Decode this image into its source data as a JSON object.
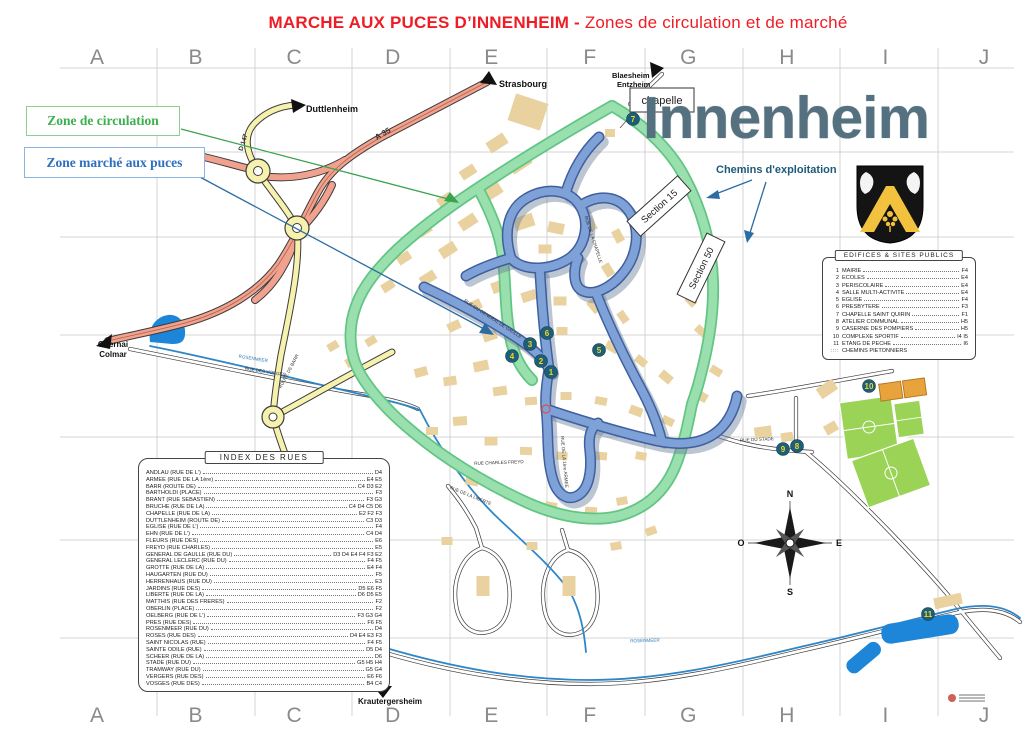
{
  "page_title": {
    "bold": "MARCHE AUX PUCES D’INNENHEIM - ",
    "regular": "Zones de circulation et de marché"
  },
  "town_name": "Innenheim",
  "legend": {
    "zone_circulation": "Zone de circulation",
    "zone_marche": "Zone marché aux puces",
    "chemins_exploitation": "Chemins d'exploitation"
  },
  "grid": {
    "letters": [
      "A",
      "B",
      "C",
      "D",
      "E",
      "F",
      "G",
      "H",
      "I",
      "J"
    ]
  },
  "destinations": [
    {
      "label": "Duttlenheim",
      "x": 306,
      "y": 112,
      "anchor": "start",
      "size": 9
    },
    {
      "label": "Strasbourg",
      "x": 499,
      "y": 87,
      "anchor": "start",
      "size": 9
    },
    {
      "label": "Blaesheim",
      "x": 612,
      "y": 78,
      "anchor": "start",
      "size": 7.5
    },
    {
      "label": "Entzheim",
      "x": 617,
      "y": 87,
      "anchor": "start",
      "size": 7.5
    },
    {
      "label": "Obernai",
      "x": 113,
      "y": 347,
      "anchor": "middle",
      "size": 8
    },
    {
      "label": "Colmar",
      "x": 113,
      "y": 357,
      "anchor": "middle",
      "size": 8
    },
    {
      "label": "Krautergersheim",
      "x": 390,
      "y": 704,
      "anchor": "middle",
      "size": 8
    }
  ],
  "road_refs": [
    {
      "label": "A 35",
      "x": 384,
      "y": 136,
      "rot": -30,
      "size": 8
    },
    {
      "label": "D 147",
      "x": 245,
      "y": 143,
      "rot": -72,
      "size": 6.5
    }
  ],
  "street_labels": [
    {
      "text": "RUE DES VOSGES",
      "x": 265,
      "y": 373,
      "rot": 9,
      "color": "#333"
    },
    {
      "text": "ROSENMEER",
      "x": 253,
      "y": 360,
      "rot": 9,
      "color": "#2a7fc0"
    },
    {
      "text": "ROSENMEER",
      "x": 645,
      "y": 642,
      "rot": -2,
      "color": "#2a7fc0"
    },
    {
      "text": "RUE CHARLES FREYD",
      "x": 499,
      "y": 464,
      "rot": -2,
      "color": "#333"
    },
    {
      "text": "RUE DU STADE",
      "x": 757,
      "y": 441,
      "rot": -3,
      "color": "#333"
    },
    {
      "text": "RUE DE LA LIBERTE",
      "x": 470,
      "y": 497,
      "rot": 22,
      "color": "#333"
    },
    {
      "text": "RUE DU GENERAL DE GAULLE",
      "x": 492,
      "y": 320,
      "rot": 33,
      "color": "#333"
    },
    {
      "text": "RUE DE LA CHAPELLE",
      "x": 592,
      "y": 240,
      "rot": 72,
      "color": "#333"
    },
    {
      "text": "ROUTE DE BARR",
      "x": 290,
      "y": 372,
      "rot": -62,
      "color": "#333"
    },
    {
      "text": "RUE DE LA 1ère ARMEE",
      "x": 563,
      "y": 462,
      "rot": 85,
      "color": "#333"
    }
  ],
  "boxed_labels": {
    "chapelle": "chapelle",
    "section15": "Section 15",
    "section50": "Section 50"
  },
  "markers": [
    {
      "n": "1",
      "x": 551,
      "y": 372
    },
    {
      "n": "2",
      "x": 541,
      "y": 361
    },
    {
      "n": "3",
      "x": 530,
      "y": 344
    },
    {
      "n": "4",
      "x": 512,
      "y": 356
    },
    {
      "n": "5",
      "x": 599,
      "y": 350
    },
    {
      "n": "6",
      "x": 547,
      "y": 333
    },
    {
      "n": "7",
      "x": 633,
      "y": 119
    },
    {
      "n": "8",
      "x": 797,
      "y": 446
    },
    {
      "n": "9",
      "x": 783,
      "y": 449
    },
    {
      "n": "10",
      "x": 869,
      "y": 386
    },
    {
      "n": "11",
      "x": 928,
      "y": 614
    }
  ],
  "compass": {
    "n": "N",
    "e": "E",
    "s": "S",
    "o": "O"
  },
  "index_rues": {
    "title": "INDEX DES RUES",
    "entries": [
      {
        "name": "ANDLAU (RUE DE L')",
        "ref": "D4"
      },
      {
        "name": "ARMEE (RUE DE LA 1ère)",
        "ref": "E4 E5"
      },
      {
        "name": "BARR (ROUTE DE)",
        "ref": "C4 D3 E2"
      },
      {
        "name": "BARTHOLDI (PLACE)",
        "ref": "F3"
      },
      {
        "name": "BRANT (RUE SEBASTIEN)",
        "ref": "F3 G3"
      },
      {
        "name": "BRUCHE (RUE DE LA)",
        "ref": "C4 D4 C5 D6"
      },
      {
        "name": "CHAPELLE (RUE DE LA)",
        "ref": "E2 F2 F3"
      },
      {
        "name": "DUTTLENHEIM (ROUTE DE)",
        "ref": "C3 D3"
      },
      {
        "name": "EGLISE (RUE DE L')",
        "ref": "F4"
      },
      {
        "name": "EHN (RUE DE L')",
        "ref": "C4 D4"
      },
      {
        "name": "FLEURS (RUE DES)",
        "ref": "E6"
      },
      {
        "name": "FREYD (RUE CHARLES)",
        "ref": "E5"
      },
      {
        "name": "GENERAL DE GAULLE (RUE DU)",
        "ref": "D3 D4 E4 F4 F3 E2"
      },
      {
        "name": "GENERAL LECLERC (RUE DU)",
        "ref": "F4 F5"
      },
      {
        "name": "GROTTE (RUE DE LA)",
        "ref": "E4 F4"
      },
      {
        "name": "HAUGARTEN (RUE DU)",
        "ref": "F5"
      },
      {
        "name": "HERRENHAUS (RUE DU)",
        "ref": "E3"
      },
      {
        "name": "JARDINS (RUE DES)",
        "ref": "D5 E6 F5"
      },
      {
        "name": "LIBERTE (RUE DE LA)",
        "ref": "D6 D5 E5"
      },
      {
        "name": "MATTHIS (RUE DES FRERES)",
        "ref": "F2"
      },
      {
        "name": "OBERLIN (PLACE)",
        "ref": "F2"
      },
      {
        "name": "OELBERG (RUE DE L')",
        "ref": "F3 G3 G4"
      },
      {
        "name": "PRES (RUE DES)",
        "ref": "F6 F5"
      },
      {
        "name": "ROSENMEER (RUE DU)",
        "ref": "D4"
      },
      {
        "name": "ROSES (RUE DES)",
        "ref": "D4 E4 E3 F3"
      },
      {
        "name": "SAINT NICOLAS (RUE)",
        "ref": "F4 F5"
      },
      {
        "name": "SAINTE ODILE (RUE)",
        "ref": "D5 D4"
      },
      {
        "name": "SCHEER (RUE DE LA)",
        "ref": "D6"
      },
      {
        "name": "STADE (RUE DU)",
        "ref": "G5 H5 H4"
      },
      {
        "name": "TRAMWAY (RUE DU)",
        "ref": "G5 G4"
      },
      {
        "name": "VERGERS (RUE DES)",
        "ref": "E6 F6"
      },
      {
        "name": "VOSGES (RUE DES)",
        "ref": "B4 C4"
      }
    ]
  },
  "edifices": {
    "title": "EDIFICES & SITES PUBLICS",
    "entries": [
      {
        "num": "1",
        "name": "MAIRIE",
        "ref": "F4"
      },
      {
        "num": "2",
        "name": "ECOLES",
        "ref": "E4"
      },
      {
        "num": "3",
        "name": "PERISCOLAIRE",
        "ref": "E4"
      },
      {
        "num": "4",
        "name": "SALLE MULTI-ACTIVITE",
        "ref": "E4"
      },
      {
        "num": "5",
        "name": "EGLISE",
        "ref": "F4"
      },
      {
        "num": "6",
        "name": "PRESBYTERE",
        "ref": "F3"
      },
      {
        "num": "7",
        "name": "CHAPELLE SAINT QUIRIN",
        "ref": "F1"
      },
      {
        "num": "8",
        "name": "ATELIER COMMUNAL",
        "ref": "H5"
      },
      {
        "num": "9",
        "name": "CASERNE DES POMPIERS",
        "ref": "H5"
      },
      {
        "num": "10",
        "name": "COMPLEXE SPORTIF",
        "ref": "I4 I5"
      },
      {
        "num": "11",
        "name": "ETANG DE PECHE",
        "ref": "I6"
      }
    ],
    "footer_key": "::::",
    "footer": "CHEMINS PIETONNIERS"
  }
}
